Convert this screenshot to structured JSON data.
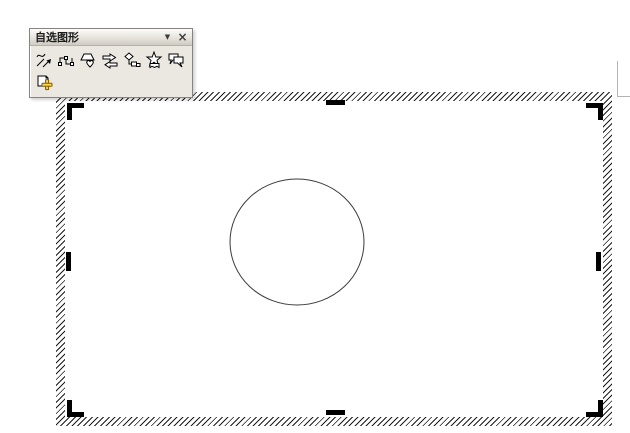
{
  "toolbar": {
    "title": "自选图形",
    "menu_arrow_icon": "▼",
    "close_icon": "×",
    "buttons": [
      {
        "icon": "lines-icon"
      },
      {
        "icon": "connectors-icon"
      },
      {
        "icon": "basic-shapes-icon"
      },
      {
        "icon": "block-arrows-icon"
      },
      {
        "icon": "flowchart-icon"
      },
      {
        "icon": "stars-banners-icon"
      },
      {
        "icon": "callouts-icon"
      },
      {
        "icon": "more-autoshapes-icon"
      }
    ]
  },
  "canvas": {
    "border_style": "diagonal-hatch",
    "hatch_color": "#1c1c1c",
    "handle_color": "#000000",
    "shape": {
      "type": "ellipse",
      "cx": 297,
      "cy": 242,
      "rx": 67,
      "ry": 63,
      "stroke": "#3c3c3c",
      "fill": "none"
    }
  },
  "page_mark": {
    "color": "#b4b4b4"
  }
}
